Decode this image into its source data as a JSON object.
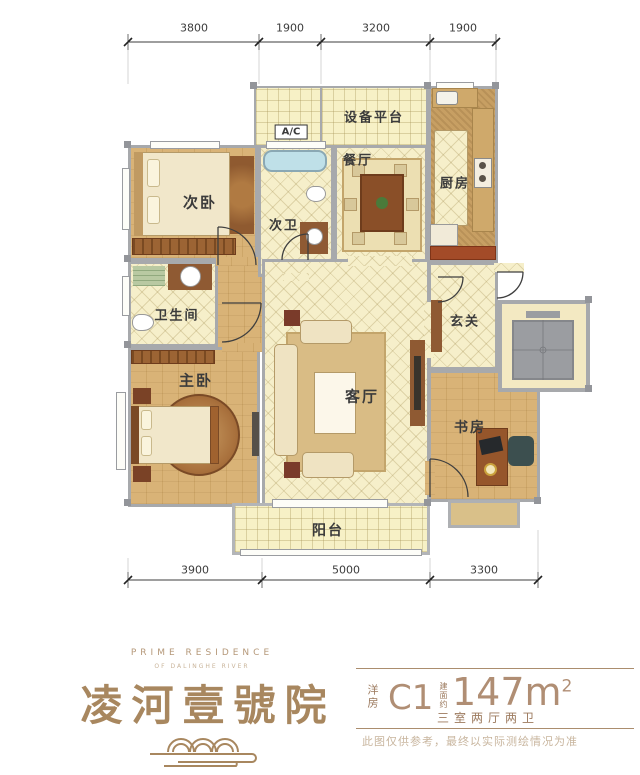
{
  "colors": {
    "brand": "#a8875f",
    "wall": "#a7a9ac",
    "wood": "#d9b377",
    "tile": "#f6efca",
    "info_text": "#9c7a5e",
    "info_big": "#b08e74"
  },
  "dims": {
    "top": [
      "3800",
      "1900",
      "3200",
      "1900"
    ],
    "bottom": [
      "3900",
      "5000",
      "3300"
    ]
  },
  "rooms": {
    "bedroom2": "次卧",
    "bath2": "次卫",
    "dining": "餐厅",
    "equipment": "设备平台",
    "ac": "A/C",
    "kitchen": "厨房",
    "bathroom": "卫生间",
    "foyer": "玄关",
    "master_bedroom": "主卧",
    "living": "客厅",
    "study": "书房",
    "balcony": "阳台"
  },
  "branding": {
    "en_title": "PRIME RESIDENCE",
    "en_subtitle": "OF DALINGHE RIVER",
    "cn_name": "凌河壹號院"
  },
  "info": {
    "type_label": "洋房",
    "unit_code": "C1",
    "area_label": "建面约",
    "area_value": "147m",
    "area_sup": "2",
    "layout": "三室两厅两卫",
    "disclaimer": "此图仅供参考，最终以实际测绘情况为准"
  }
}
